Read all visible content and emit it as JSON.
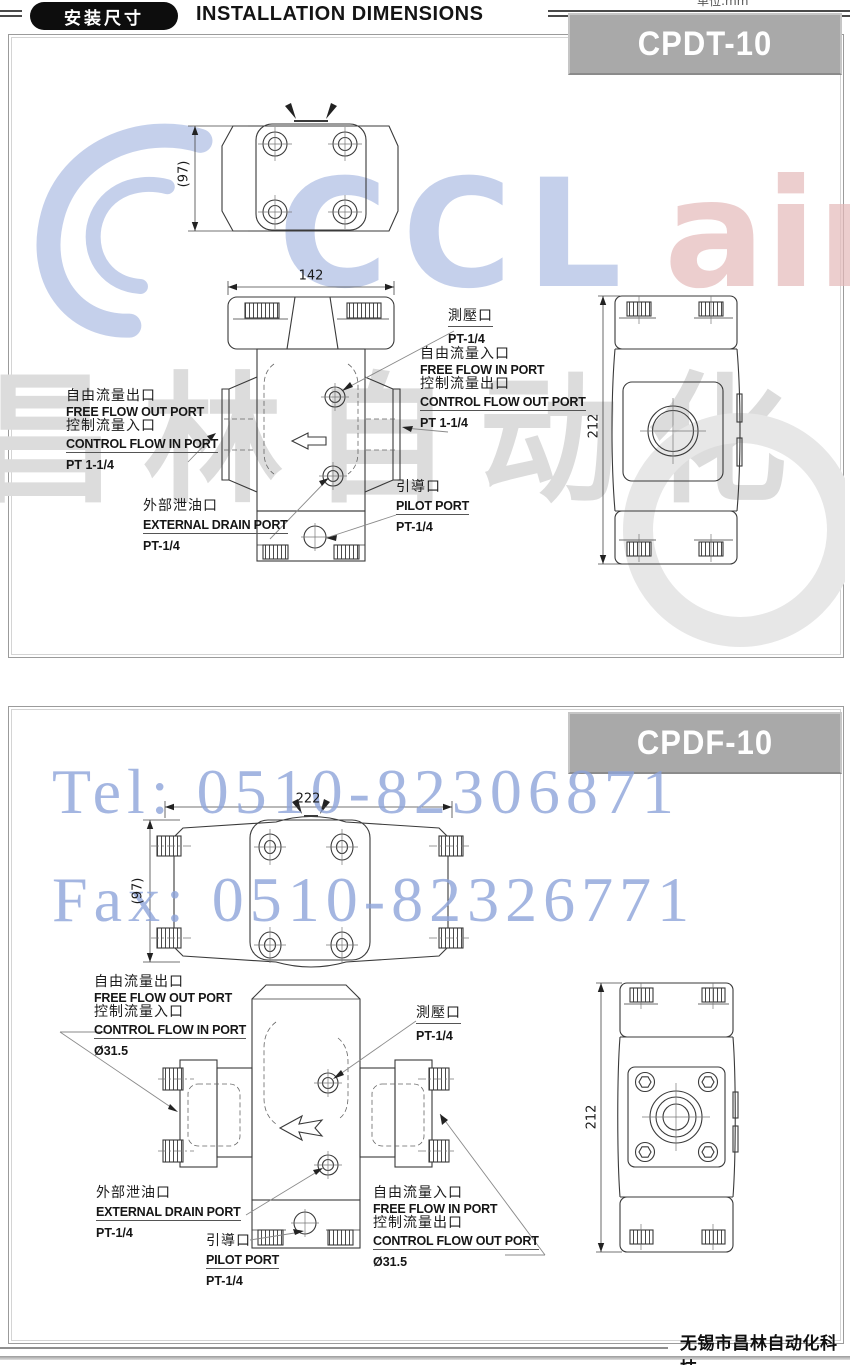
{
  "header": {
    "badge": "安装尺寸",
    "title": "INSTALLATION DIMENSIONS",
    "unit_note": "单位:mm"
  },
  "watermarks": {
    "brand_left": "CCL",
    "brand_right": "air",
    "brand_cn": "昌林自动化",
    "tel": "Tel: 0510-82306871",
    "fax": "Fax: 0510-82326771"
  },
  "footer": {
    "company": "无锡市昌林自动化科技"
  },
  "colors": {
    "banner_bg": "#a9a9a9",
    "watermark_blue": "#8ea4da",
    "watermark_gray": "#dcdcdc",
    "line_art": "#3a3a3a"
  },
  "sections": [
    {
      "model": "CPDT-10",
      "dims": {
        "width": "142",
        "depth": "(97)",
        "height": "212"
      },
      "labels": {
        "free_out": {
          "cn": "自由流量出口",
          "en": "FREE FLOW OUT PORT"
        },
        "ctrl_in": {
          "cn": "控制流量入口",
          "en": "CONTROL FLOW IN PORT"
        },
        "left_size": "PT 1-1/4",
        "gauge": {
          "cn": "測壓口",
          "size": "PT-1/4"
        },
        "free_in": {
          "cn": "自由流量入口",
          "en": "FREE FLOW IN PORT"
        },
        "ctrl_out": {
          "cn": "控制流量出口",
          "en": "CONTROL FLOW OUT PORT"
        },
        "right_size": "PT 1-1/4",
        "drain": {
          "cn": "外部泄油口",
          "en": "EXTERNAL DRAIN PORT",
          "size": "PT-1/4"
        },
        "pilot": {
          "cn": "引導口",
          "en": "PILOT PORT",
          "size": "PT-1/4"
        }
      }
    },
    {
      "model": "CPDF-10",
      "dims": {
        "width": "222",
        "depth": "(97)",
        "height": "212"
      },
      "labels": {
        "free_out": {
          "cn": "自由流量出口",
          "en": "FREE FLOW OUT PORT"
        },
        "ctrl_in": {
          "cn": "控制流量入口",
          "en": "CONTROL FLOW IN PORT"
        },
        "left_size": "Ø31.5",
        "gauge": {
          "cn": "測壓口",
          "size": "PT-1/4"
        },
        "free_in": {
          "cn": "自由流量入口",
          "en": "FREE FLOW IN PORT"
        },
        "ctrl_out": {
          "cn": "控制流量出口",
          "en": "CONTROL FLOW OUT PORT"
        },
        "right_size": "Ø31.5",
        "drain": {
          "cn": "外部泄油口",
          "en": "EXTERNAL DRAIN PORT",
          "size": "PT-1/4"
        },
        "pilot": {
          "cn": "引導口",
          "en": "PILOT PORT",
          "size": "PT-1/4"
        }
      }
    }
  ]
}
